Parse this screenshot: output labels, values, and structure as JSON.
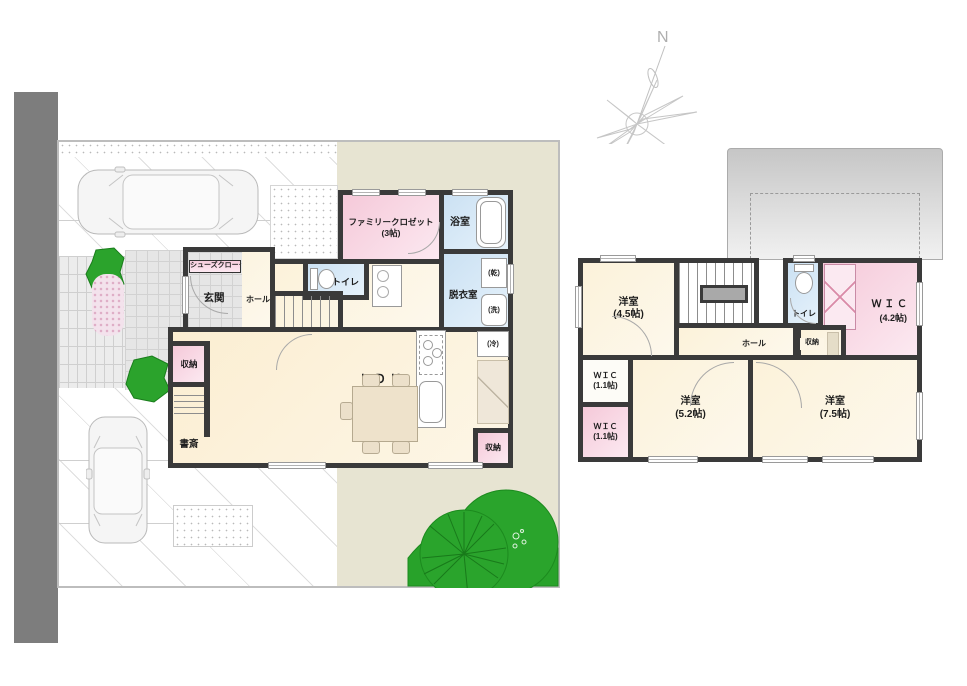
{
  "compass": {
    "north_label": "N"
  },
  "floor1": {
    "family_closet": {
      "name": "ファミリークロゼット",
      "size": "(3帖)"
    },
    "bath": {
      "name": "浴室"
    },
    "dressing": {
      "name": "脱衣室"
    },
    "dryer": "(乾)",
    "washer": "(洗)",
    "toilet": {
      "name": "トイレ"
    },
    "shoes_cloak": {
      "name": "シューズクローク"
    },
    "entrance": {
      "name": "玄関"
    },
    "hall": {
      "name": "ホール"
    },
    "ldk": {
      "name": "Ｌ Ｄ Ｋ",
      "size": "(18.2帖)"
    },
    "storage_left": {
      "name": "収納"
    },
    "study": {
      "name": "書斎"
    },
    "fridge": "(冷)",
    "storage_right": {
      "name": "収納"
    }
  },
  "floor2": {
    "bedroom_a": {
      "name": "洋室",
      "size": "(4.5帖)"
    },
    "toilet": {
      "name": "トイレ"
    },
    "wic_large": {
      "name": "Ｗ Ｉ Ｃ",
      "size": "(4.2帖)"
    },
    "hall": {
      "name": "ホール"
    },
    "storage": {
      "name": "収納"
    },
    "wic_small_upper": {
      "name": "ＷＩＣ",
      "size": "(1.1帖)"
    },
    "wic_small_lower": {
      "name": "ＷＩＣ",
      "size": "(1.1帖)"
    },
    "bedroom_b": {
      "name": "洋室",
      "size": "(5.2帖)"
    },
    "bedroom_c": {
      "name": "洋室",
      "size": "(7.5帖)"
    }
  },
  "colors": {
    "wall": "#3a3a3a",
    "room_cream": "#fdf4e1",
    "room_pink": "#f6cddb",
    "room_blue": "#cfe3f2",
    "site_beige": "#e7e4d2",
    "road_gray": "#7d7d7d",
    "tree_green": "#2aa32c"
  }
}
